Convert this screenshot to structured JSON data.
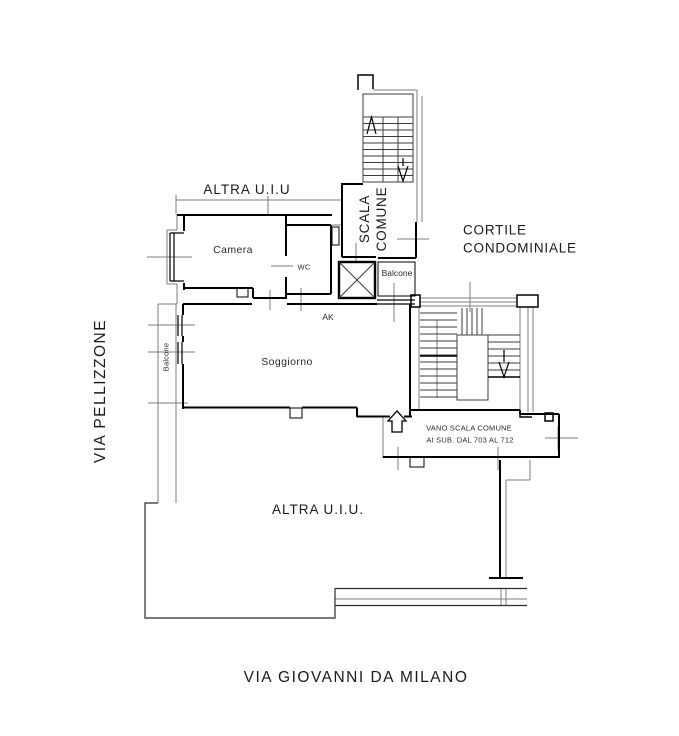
{
  "plan": {
    "streets": {
      "left": "VIA PELLIZZONE",
      "bottom": "VIA GIOVANNI DA MILANO"
    },
    "areas": {
      "altra_uiu_top": "ALTRA U.I.U",
      "altra_uiu_bottom": "ALTRA U.I.U.",
      "cortile_line1": "CORTILE",
      "cortile_line2": "CONDOMINIALE",
      "scala_line1": "SCALA",
      "scala_line2": "COMUNE",
      "vano_line1": "VANO SCALA COMUNE",
      "vano_line2": "AI SUB. DAL 703 AL 712"
    },
    "rooms": {
      "camera": "Camera",
      "wc": "WC",
      "soggiorno": "Soggiorno",
      "ak": "AK",
      "balcone_left": "Balcone",
      "balcone_small": "Balcone"
    },
    "colors": {
      "walls": "#000000",
      "outline": "#7e7e7e",
      "background": "#ffffff"
    }
  }
}
